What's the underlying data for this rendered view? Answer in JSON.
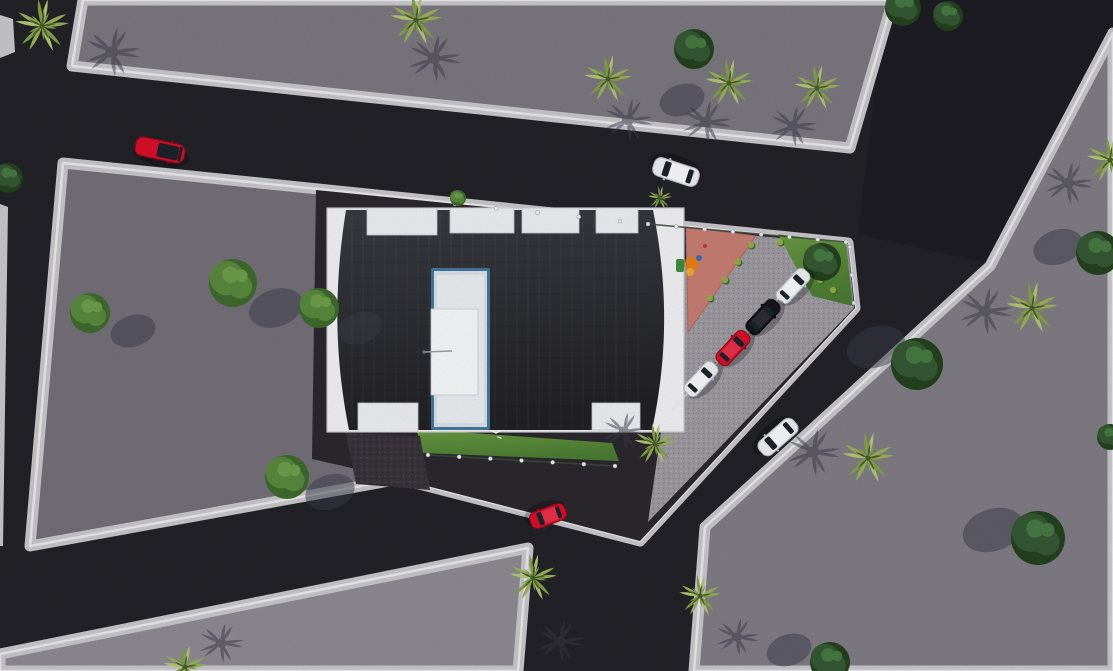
{
  "meta": {
    "title": "aerial-3d-site-plan-render",
    "description": "Top-down 3D architectural rendering: dark flat-roof building with stair core, triangular parking lot with four parked cars, playground, lawns, asphalt roads with moving cars, palm and round trees on gray plots."
  },
  "canvas": {
    "w": 1113,
    "h": 671
  },
  "palette": {
    "road": "#232228",
    "roadNE": "#1e1d24",
    "sidewalk": "#c9c9cd",
    "sidewalkBright": "#ebebee",
    "plotTop": "#7b7880",
    "plotCentral": "#757079",
    "plotRight": "#817d85",
    "plotBottom": "#8e8b92",
    "sitePaving": "#2b292e",
    "parkingPave": "#9d9aa0",
    "parkingDot1": "#bab7bd",
    "parkingDot2": "#84818a",
    "playground": "#c87e73",
    "playgroundEdge": "#b06a60",
    "grass1": "#6a9b43",
    "grass2": "#4c7c33",
    "gravel": "#3a343b",
    "gravelDot1": "#4a434c",
    "gravelDot2": "#2c272e",
    "white": "#f3f3f5",
    "buildingEdge": "#c9c9cf",
    "roofTop": "#3a3b41",
    "roofBottom": "#222226",
    "coreBlue": "#43789e",
    "coreFill1": "#dce2e8",
    "coreFill2": "#ecf0f3",
    "coreBright": "#f9fafc",
    "notch": "#eef0f3",
    "notchLine": "#c9ced3",
    "palmLight1": "#9cb257",
    "palmLight2": "#84a04a",
    "palmHi": "#b6c775",
    "palmCenter": "#4a5f2c",
    "treeMid1": "#5a8a3e",
    "treeMid2": "#3f6b2e",
    "treeDark1": "#355933",
    "treeDark2": "#24421f",
    "shadow": "#3b3b49",
    "carRed": "#d8102a",
    "carRedDark": "#8f0a1c",
    "carWhite": "#eef0f2",
    "carWhiteDark": "#b4b8bf",
    "carBlack": "#17171b",
    "glass": "#1d232b",
    "post": "#f2f2f4",
    "fence": "#3d4a3d"
  },
  "scene": {
    "underlays": [
      {
        "name": "road-ne-dark",
        "pts": [
          [
            885,
            0
          ],
          [
            1113,
            0
          ],
          [
            1113,
            28
          ],
          [
            987,
            263
          ],
          [
            858,
            234
          ]
        ],
        "fill": "roadNE"
      },
      {
        "name": "sidewalk-strip-topleft",
        "pts": [
          [
            0,
            15
          ],
          [
            13,
            19
          ],
          [
            15,
            52
          ],
          [
            0,
            58
          ]
        ],
        "fill": "sidewalk"
      },
      {
        "name": "sidewalk-strip-left-edge",
        "pts": [
          [
            0,
            204
          ],
          [
            8,
            207
          ],
          [
            3,
            546
          ],
          [
            0,
            546
          ]
        ],
        "fill": "sidewalk"
      }
    ],
    "plots": [
      {
        "name": "plot-top",
        "pts": [
          [
            83,
            0
          ],
          [
            893,
            0
          ],
          [
            850,
            148
          ],
          [
            72,
            66
          ]
        ],
        "fill": "plotTop"
      },
      {
        "name": "plot-central",
        "pts": [
          [
            63,
            163
          ],
          [
            848,
            243
          ],
          [
            855,
            308
          ],
          [
            640,
            541
          ],
          [
            400,
            479
          ],
          [
            30,
            546
          ]
        ],
        "fill": "plotCentral"
      },
      {
        "name": "plot-right",
        "pts": [
          [
            1113,
            33
          ],
          [
            990,
            266
          ],
          [
            856,
            389
          ],
          [
            705,
            527
          ],
          [
            694,
            671
          ],
          [
            1113,
            671
          ]
        ],
        "fill": "plotRight"
      },
      {
        "name": "plot-bottom",
        "pts": [
          [
            0,
            654
          ],
          [
            528,
            548
          ],
          [
            518,
            671
          ],
          [
            0,
            671
          ]
        ],
        "fill": "plotBottom"
      }
    ],
    "decals": [
      {
        "name": "site-paving",
        "pts": [
          [
            316,
            190
          ],
          [
            848,
            243
          ],
          [
            855,
            308
          ],
          [
            640,
            541
          ],
          [
            400,
            479
          ],
          [
            312,
            459
          ]
        ],
        "fill": "sitePaving"
      },
      {
        "name": "parking-pavement",
        "pts": [
          [
            690,
            230
          ],
          [
            848,
            244
          ],
          [
            854,
            308
          ],
          [
            648,
            522
          ]
        ],
        "fill": "pattern:parking"
      },
      {
        "name": "playground",
        "pts": [
          [
            686,
            227
          ],
          [
            756,
            236
          ],
          [
            688,
            332
          ]
        ],
        "fill": "playground",
        "stroke": "playgroundEdge"
      },
      {
        "name": "grass-ne",
        "pts": [
          [
            778,
            234
          ],
          [
            846,
            243
          ],
          [
            853,
            306
          ],
          [
            812,
            296
          ]
        ],
        "fill": "grad:grass"
      },
      {
        "name": "grass-south",
        "pts": [
          [
            416,
            429
          ],
          [
            612,
            443
          ],
          [
            619,
            461
          ],
          [
            423,
            453
          ]
        ],
        "fill": "grad:grass"
      },
      {
        "name": "gravel-patch",
        "pts": [
          [
            346,
            433
          ],
          [
            420,
            436
          ],
          [
            430,
            490
          ],
          [
            356,
            484
          ]
        ],
        "fill": "pattern:gravel"
      }
    ],
    "building": {
      "base": [
        327,
        208,
        357,
        224
      ],
      "roofPath": "M346,210 C334,285 334,355 349,430 L652,430 C668,355 668,285 653,210 Z",
      "topNotches": [
        [
          367,
          208,
          70,
          27
        ],
        [
          450,
          208,
          64,
          25
        ],
        [
          522,
          208,
          57,
          25
        ],
        [
          596,
          208,
          42,
          25
        ]
      ],
      "bottomNotches": [
        [
          358,
          403,
          60,
          29
        ],
        [
          592,
          403,
          48,
          27
        ]
      ],
      "core": {
        "outer": [
          431,
          268,
          59,
          162
        ],
        "inner": [
          434,
          271,
          53,
          156
        ],
        "inner2": [
          437,
          275,
          47,
          148
        ],
        "bright": [
          431,
          309,
          47,
          86
        ]
      },
      "antenna": [
        424,
        352,
        452,
        351
      ],
      "seams": {
        "x1": 352,
        "x2": 648,
        "stepX": 11,
        "y1": 214,
        "y2": 428,
        "stepY": 16
      }
    },
    "fences": [
      {
        "name": "fence-north",
        "from": [
          455,
          204
        ],
        "to": [
          620,
          221
        ],
        "posts": 5,
        "line": false
      },
      {
        "name": "fence-playground-top",
        "from": [
          648,
          224
        ],
        "to": [
          846,
          242
        ],
        "posts": 8,
        "line": true
      },
      {
        "name": "fence-east-tip",
        "from": [
          850,
          247
        ],
        "to": [
          854,
          303
        ],
        "posts": 3,
        "line": false
      },
      {
        "name": "fence-south-lawn",
        "from": [
          428,
          455
        ],
        "to": [
          615,
          466
        ],
        "posts": 7,
        "line": true
      }
    ],
    "stallLines": {
      "centers": [
        [
          809,
          268
        ],
        [
          778,
          299
        ],
        [
          748,
          332
        ],
        [
          717,
          363
        ],
        [
          687,
          394
        ]
      ],
      "angle": -47,
      "len": 44
    },
    "playEquipment": [
      {
        "t": "rect",
        "x": 676,
        "y": 259,
        "w": 8,
        "h": 13,
        "rx": 2,
        "f": "#3f8f3a"
      },
      {
        "t": "circle",
        "x": 692,
        "y": 264,
        "r": 7,
        "f": "#e5821c"
      },
      {
        "t": "circle",
        "x": 690,
        "y": 272,
        "r": 4,
        "f": "#f2aa2e"
      },
      {
        "t": "circle",
        "x": 699,
        "y": 258,
        "r": 3,
        "f": "#3a6fc0"
      },
      {
        "t": "circle",
        "x": 705,
        "y": 246,
        "r": 2,
        "f": "#c03a30"
      }
    ],
    "bushDots": [
      [
        751,
        245
      ],
      [
        738,
        262
      ],
      [
        725,
        280
      ],
      [
        710,
        298
      ],
      [
        780,
        242
      ],
      [
        820,
        280
      ],
      [
        833,
        290
      ]
    ],
    "bird": [
      "M492,431 l4,2 4,-2",
      "M498,437 l3,1"
    ],
    "palms": [
      {
        "x": 42,
        "y": 26,
        "r": 27,
        "sh": [
          112,
          52
        ]
      },
      {
        "x": 416,
        "y": 20,
        "r": 26,
        "sh": [
          434,
          58
        ]
      },
      {
        "x": 608,
        "y": 79,
        "r": 24,
        "sh": [
          628,
          120
        ]
      },
      {
        "x": 729,
        "y": 83,
        "r": 24,
        "sh": [
          706,
          122
        ]
      },
      {
        "x": 817,
        "y": 88,
        "r": 23,
        "sh": [
          793,
          126
        ]
      },
      {
        "x": 1110,
        "y": 160,
        "r": 24,
        "sh": [
          1068,
          183
        ]
      },
      {
        "x": 1032,
        "y": 308,
        "r": 26,
        "sh": [
          985,
          311
        ]
      },
      {
        "x": 868,
        "y": 458,
        "r": 26,
        "sh": [
          813,
          452
        ]
      },
      {
        "x": 655,
        "y": 444,
        "r": 21,
        "sh": [
          624,
          431
        ]
      },
      {
        "x": 700,
        "y": 596,
        "r": 21,
        "sh": [
          737,
          637
        ]
      },
      {
        "x": 533,
        "y": 578,
        "r": 24,
        "sh": [
          560,
          641
        ]
      },
      {
        "x": 185,
        "y": 667,
        "r": 22,
        "sh": [
          221,
          643
        ]
      },
      {
        "x": 660,
        "y": 198,
        "r": 12,
        "sh": null
      }
    ],
    "roundTrees": [
      {
        "x": 90,
        "y": 313,
        "r": 20,
        "tone": "mid",
        "sh": [
          133,
          331
        ]
      },
      {
        "x": 233,
        "y": 283,
        "r": 24,
        "tone": "mid",
        "sh": [
          276,
          308
        ]
      },
      {
        "x": 319,
        "y": 308,
        "r": 20,
        "tone": "mid",
        "sh": [
          360,
          328
        ]
      },
      {
        "x": 287,
        "y": 477,
        "r": 22,
        "tone": "mid",
        "sh": [
          330,
          492
        ]
      },
      {
        "x": 458,
        "y": 198,
        "r": 8,
        "tone": "mid",
        "sh": null
      },
      {
        "x": 822,
        "y": 262,
        "r": 19,
        "tone": "dark",
        "sh": null
      },
      {
        "x": 694,
        "y": 49,
        "r": 20,
        "tone": "dark",
        "sh": [
          682,
          100
        ]
      },
      {
        "x": 903,
        "y": 8,
        "r": 18,
        "tone": "dark",
        "sh": null
      },
      {
        "x": 948,
        "y": 16,
        "r": 15,
        "tone": "dark",
        "sh": null
      },
      {
        "x": 1098,
        "y": 253,
        "r": 22,
        "tone": "dark",
        "sh": [
          1058,
          247
        ]
      },
      {
        "x": 917,
        "y": 364,
        "r": 26,
        "tone": "dark",
        "sh": [
          876,
          347
        ]
      },
      {
        "x": 1038,
        "y": 538,
        "r": 27,
        "tone": "dark",
        "sh": [
          993,
          530
        ]
      },
      {
        "x": 830,
        "y": 662,
        "r": 20,
        "tone": "dark",
        "sh": [
          789,
          650
        ]
      },
      {
        "x": 8,
        "y": 178,
        "r": 15,
        "tone": "dark",
        "sh": null
      },
      {
        "x": 1110,
        "y": 437,
        "r": 13,
        "tone": "dark",
        "sh": null
      }
    ],
    "cars": [
      {
        "name": "car-red-top-road",
        "x": 160,
        "y": 150,
        "a": 12,
        "l": 50,
        "w": 19,
        "color": "red",
        "style": "convertible"
      },
      {
        "name": "car-white-top-road",
        "x": 676,
        "y": 172,
        "a": 198,
        "l": 47,
        "w": 19,
        "color": "white",
        "style": "sedan"
      },
      {
        "name": "car-white-east-road",
        "x": 778,
        "y": 437,
        "a": 139,
        "l": 45,
        "w": 18,
        "color": "white",
        "style": "sedan"
      },
      {
        "name": "car-red-junction",
        "x": 548,
        "y": 516,
        "a": 160,
        "l": 37,
        "w": 17,
        "color": "red",
        "style": "sedan"
      },
      {
        "name": "parked-car-white-1",
        "x": 793,
        "y": 286,
        "a": -47,
        "l": 40,
        "w": 16,
        "color": "white",
        "style": "sedan"
      },
      {
        "name": "parked-car-black",
        "x": 763,
        "y": 317,
        "a": -47,
        "l": 40,
        "w": 16,
        "color": "black",
        "style": "sedan"
      },
      {
        "name": "parked-car-red",
        "x": 733,
        "y": 348,
        "a": -47,
        "l": 40,
        "w": 16,
        "color": "red",
        "style": "sedan"
      },
      {
        "name": "parked-car-white-2",
        "x": 701,
        "y": 379,
        "a": -47,
        "l": 40,
        "w": 16,
        "color": "white",
        "style": "sedan"
      }
    ]
  }
}
